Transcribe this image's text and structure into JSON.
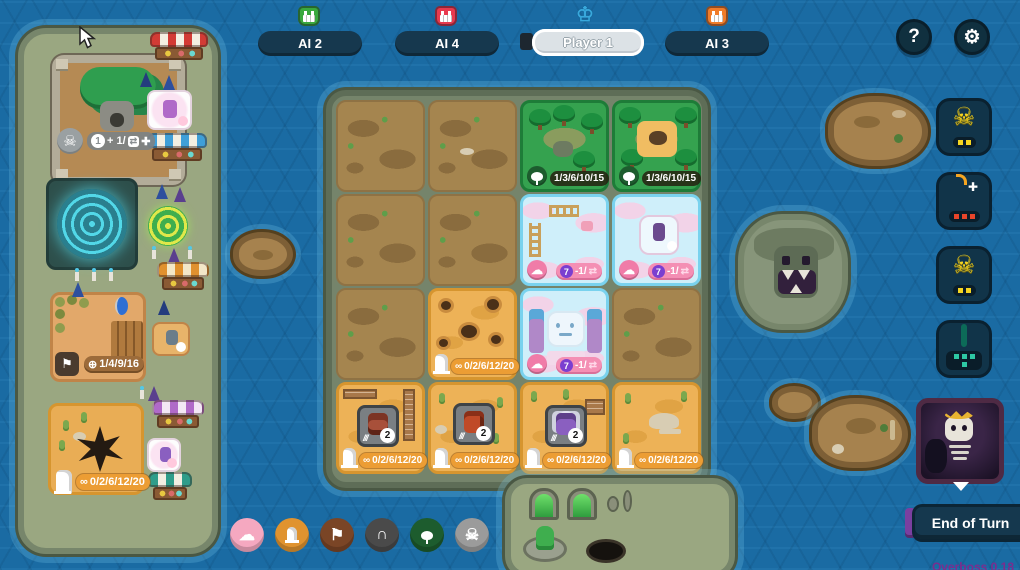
{
  "app": {
    "version": "Overboss 0.18"
  },
  "colors": {
    "water": "#1a6ba3",
    "pill_navy": "#16384e",
    "active_pill": "#dce2e6",
    "forest_green": "#2fa24c",
    "cloud_pink": "#f48fb4",
    "desert_orange": "#ec9d34",
    "ability_yellow": "#f5d521",
    "ability_red": "#e8452a",
    "ability_teal": "#2ec8a4",
    "boss_purple": "#7a3fa0"
  },
  "top_bar": {
    "players": [
      {
        "name": "AI 2",
        "icon": "green-monster-icon",
        "color": "#3aa83e",
        "active": false
      },
      {
        "name": "AI 4",
        "icon": "red-monster-icon",
        "color": "#e83a4e",
        "active": false
      },
      {
        "name": "Player 1",
        "icon": "crown-icon",
        "color": "#39a8dc",
        "active": true
      },
      {
        "name": "AI 3",
        "icon": "orange-monster-icon",
        "color": "#f07c2a",
        "active": false
      }
    ],
    "help_label": "?",
    "settings_icon": "gear-icon"
  },
  "left_island": {
    "lair": {
      "icon": "horned-skull-icon",
      "badge_circle": "1",
      "badge_text": "+ 1/",
      "badge_icons": [
        "swap-icon",
        "plus-icon"
      ]
    },
    "fort": {
      "icon": "flag-icon",
      "badge_prefix_icon": "token-icon",
      "badge_text": "1/4/9/16"
    },
    "vortex": {
      "icon": "statue-icon",
      "badge_prefix_icon": "link-icon",
      "badge_text": "0/2/6/12/20"
    },
    "shops": [
      {
        "awning": "red"
      },
      {
        "awning": "blue"
      },
      {
        "awning": "orange"
      },
      {
        "awning": "purple"
      },
      {
        "awning": "teal"
      }
    ]
  },
  "board": {
    "tiles": [
      {
        "row": 1,
        "col": 1,
        "type": "dirt"
      },
      {
        "row": 1,
        "col": 2,
        "type": "dirt"
      },
      {
        "row": 1,
        "col": 3,
        "type": "forest",
        "icon": "tree-icon",
        "badge": "1/3/6/10/15"
      },
      {
        "row": 1,
        "col": 4,
        "type": "forest",
        "icon": "tree-icon",
        "badge": "1/3/6/10/15"
      },
      {
        "row": 2,
        "col": 1,
        "type": "dirt"
      },
      {
        "row": 2,
        "col": 2,
        "type": "dirt"
      },
      {
        "row": 2,
        "col": 3,
        "type": "cloud",
        "icon": "cloud-icon",
        "score": "7",
        "modifier": "-1/"
      },
      {
        "row": 2,
        "col": 4,
        "type": "cloud",
        "icon": "cloud-icon",
        "score": "7",
        "modifier": "-1/"
      },
      {
        "row": 3,
        "col": 1,
        "type": "dirt"
      },
      {
        "row": 3,
        "col": 2,
        "type": "desert",
        "icon": "statue-icon",
        "badge": "0/2/6/12/20"
      },
      {
        "row": 3,
        "col": 3,
        "type": "cloud-castle",
        "icon": "cloud-icon",
        "score": "7",
        "modifier": "-1/"
      },
      {
        "row": 3,
        "col": 4,
        "type": "dirt"
      },
      {
        "row": 4,
        "col": 1,
        "type": "desert",
        "icon": "statue-icon",
        "badge": "0/2/6/12/20",
        "monster_power": "2"
      },
      {
        "row": 4,
        "col": 2,
        "type": "desert",
        "icon": "statue-icon",
        "badge": "0/2/6/12/20",
        "monster_power": "2"
      },
      {
        "row": 4,
        "col": 3,
        "type": "desert",
        "icon": "statue-icon",
        "badge": "0/2/6/12/20",
        "monster_power": "2"
      },
      {
        "row": 4,
        "col": 4,
        "type": "desert",
        "icon": "statue-icon",
        "badge": "0/2/6/12/20"
      }
    ]
  },
  "right_panel": {
    "ability_buttons": [
      {
        "icon": "horned-skull-icon",
        "color": "#f5d521",
        "dots": 2
      },
      {
        "icon": "bomb-icon",
        "color": "#e8452a",
        "dots": 3
      },
      {
        "icon": "horned-skull-icon",
        "color": "#f5d521",
        "dots": 2
      },
      {
        "icon": "jaw-icon",
        "color": "#2ec8a4",
        "dots": 4
      }
    ],
    "boss_portrait": "skeleton-king",
    "end_turn_label": "End of Turn"
  },
  "bottom_toolbar": {
    "terrain_buttons": [
      {
        "name": "cloud",
        "color": "#f5a8c0",
        "icon": "cloud-icon"
      },
      {
        "name": "desert",
        "color": "#e0932f",
        "icon": "statue-icon"
      },
      {
        "name": "banner",
        "color": "#7a4526",
        "icon": "flag-icon"
      },
      {
        "name": "cave",
        "color": "#4a4a4a",
        "icon": "arch-icon"
      },
      {
        "name": "forest",
        "color": "#1d5c2e",
        "icon": "tree-icon"
      },
      {
        "name": "skull",
        "color": "#9b9b9b",
        "icon": "skull-icon"
      }
    ]
  }
}
